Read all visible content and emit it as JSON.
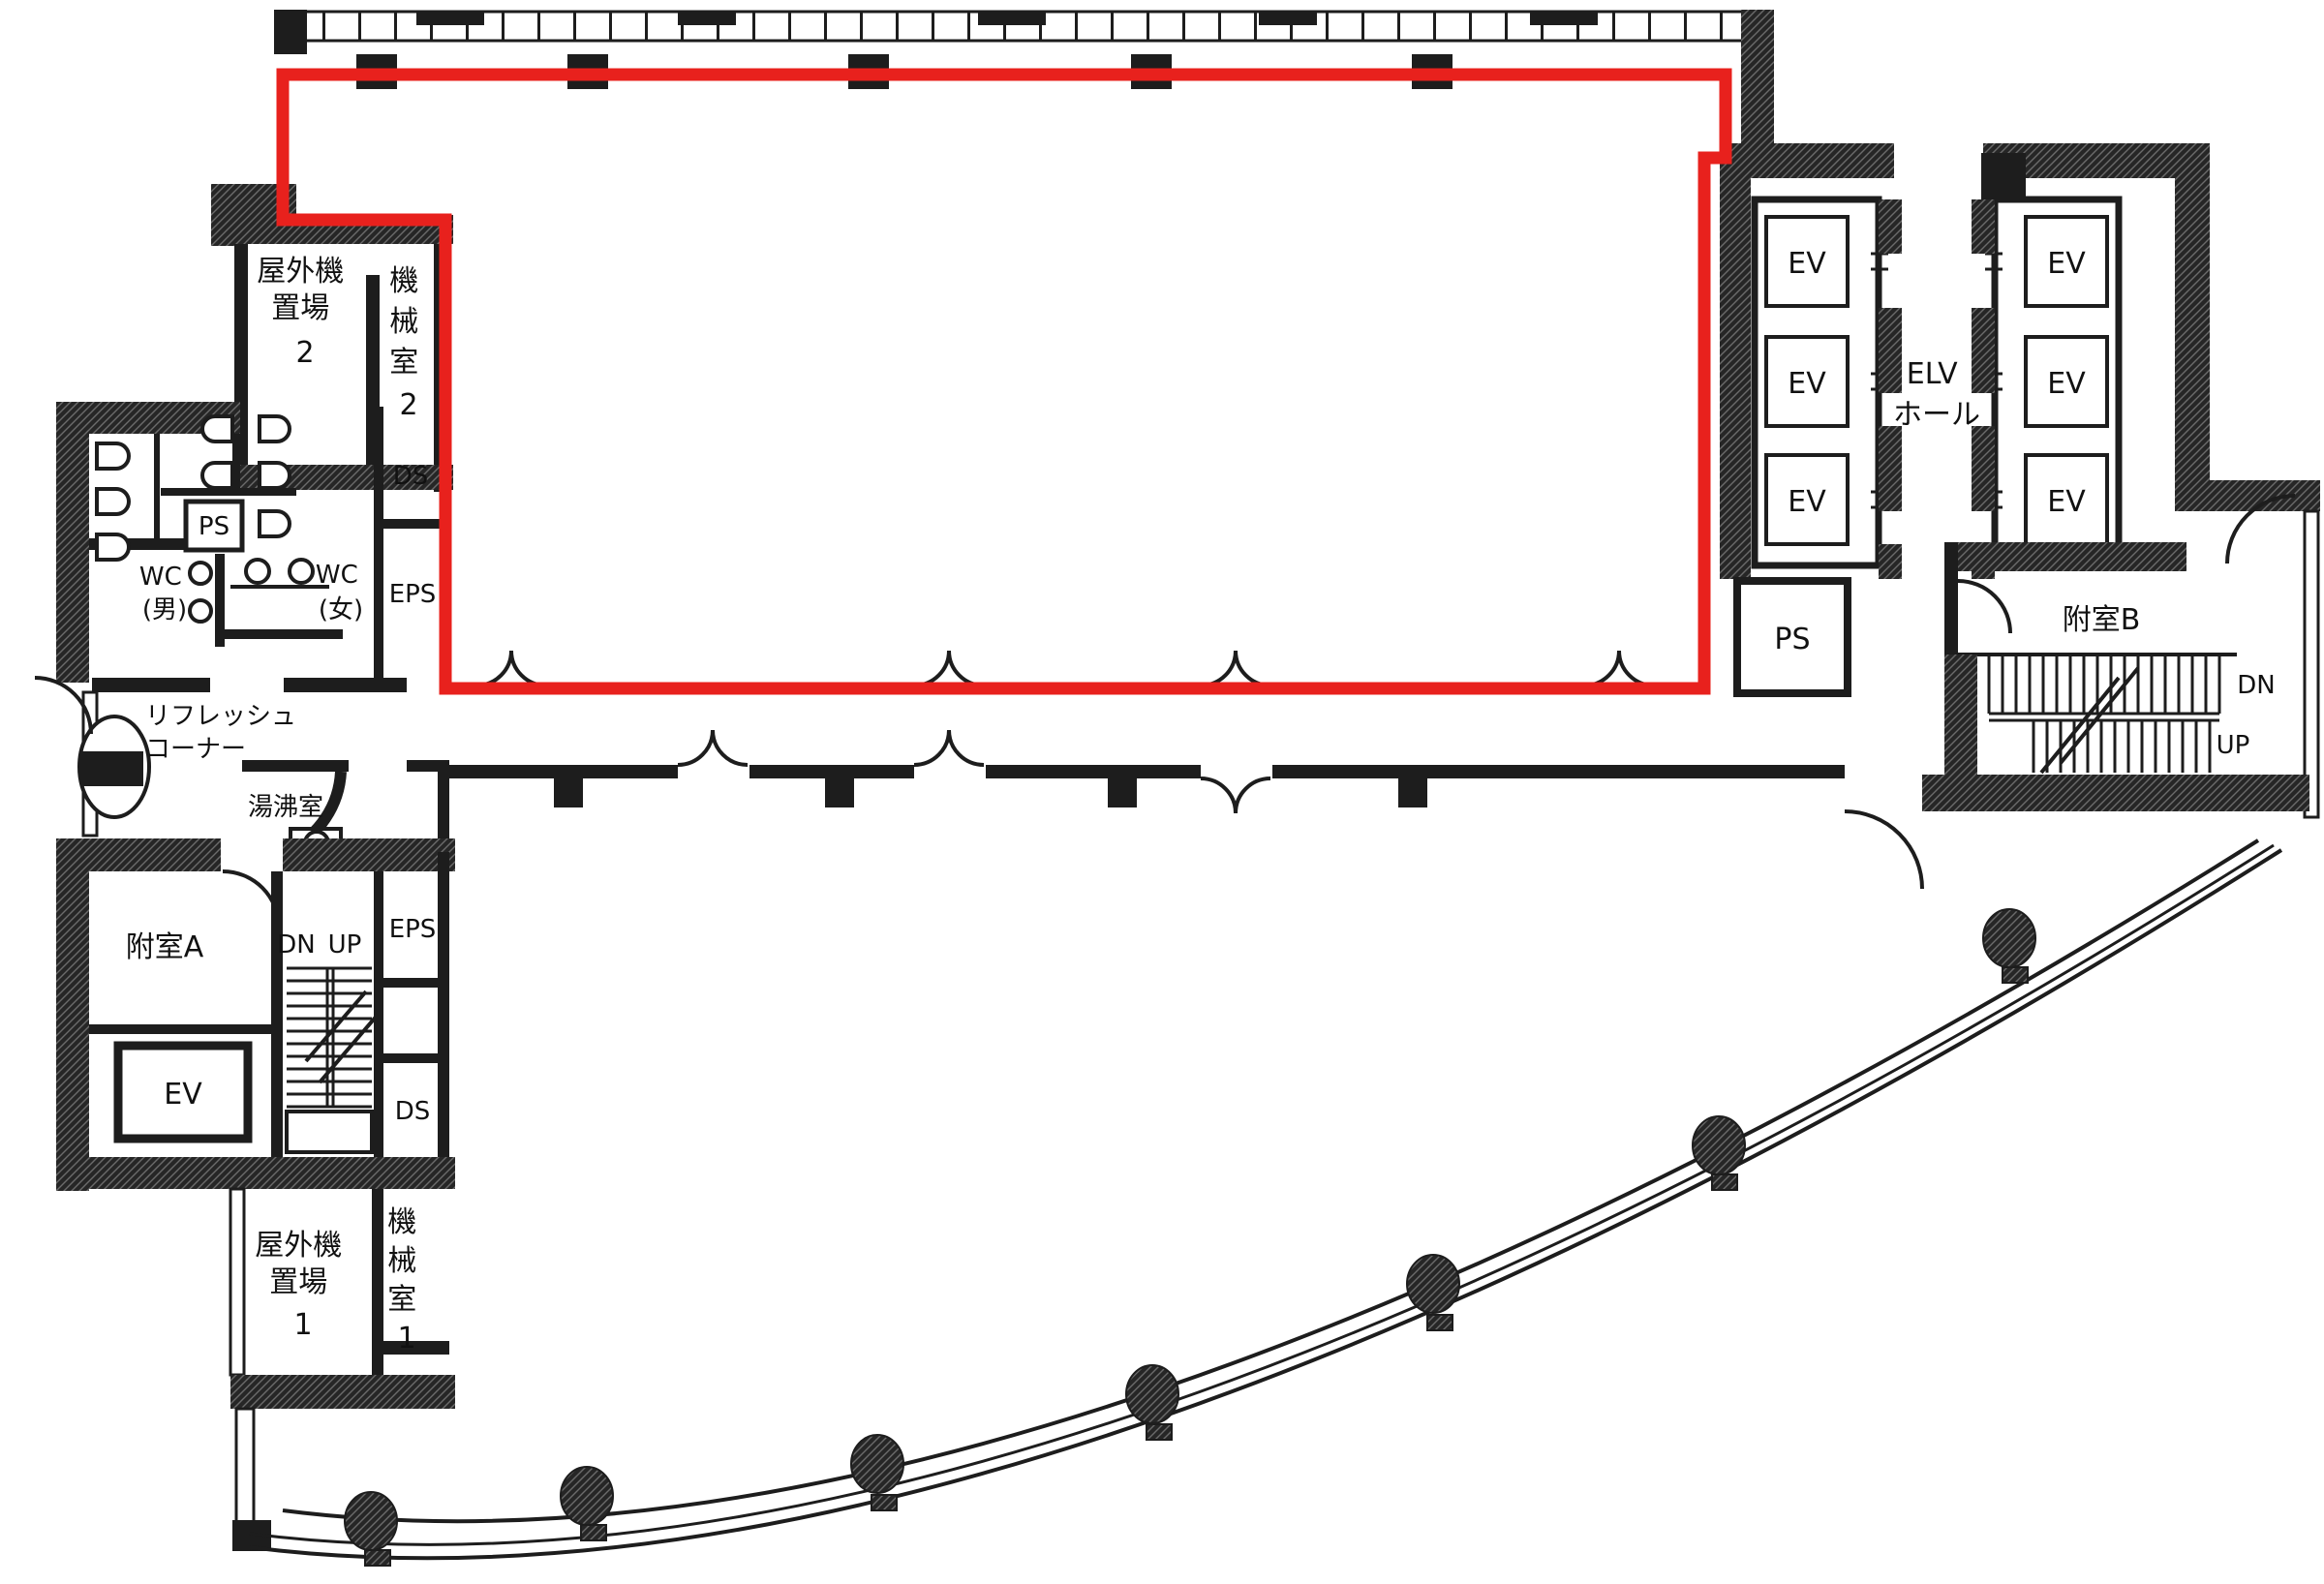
{
  "diagram": {
    "kind": "building floor plan (Japanese office floor)",
    "colors": {
      "outline_red": "#e8211d",
      "wall": "#1d1d1d",
      "paper": "#ffffff"
    }
  },
  "labels": {
    "okugaiki2": {
      "l1": "屋外機",
      "l2": "置場",
      "l3": "2"
    },
    "kikaishitsu2": {
      "c1": "機",
      "c2": "械",
      "c3": "室",
      "c4": "2"
    },
    "ps_wc": "PS",
    "wc_male": {
      "l1": "WC",
      "l2": "(男)"
    },
    "wc_female": {
      "l1": "WC",
      "l2": "(女)"
    },
    "ds_upper": "DS",
    "eps_upper": "EPS",
    "refresh": {
      "l1": "リフレッシュ",
      "l2": "コーナー"
    },
    "yuwakashi": "湯沸室",
    "eps_lower": "EPS",
    "fushitsu_a": "附室A",
    "dn": "DN",
    "up": "UP",
    "ev": "EV",
    "ds_lower": "DS",
    "okugaiki1": {
      "l1": "屋外機",
      "l2": "置場",
      "l3": "1"
    },
    "kikaishitsu1": {
      "c1": "機",
      "c2": "械",
      "c3": "室",
      "c4": "1"
    },
    "elv_hall": {
      "l1": "ELV",
      "l2": "ホール"
    },
    "ps_right": "PS",
    "fushitsu_b": "附室B"
  }
}
